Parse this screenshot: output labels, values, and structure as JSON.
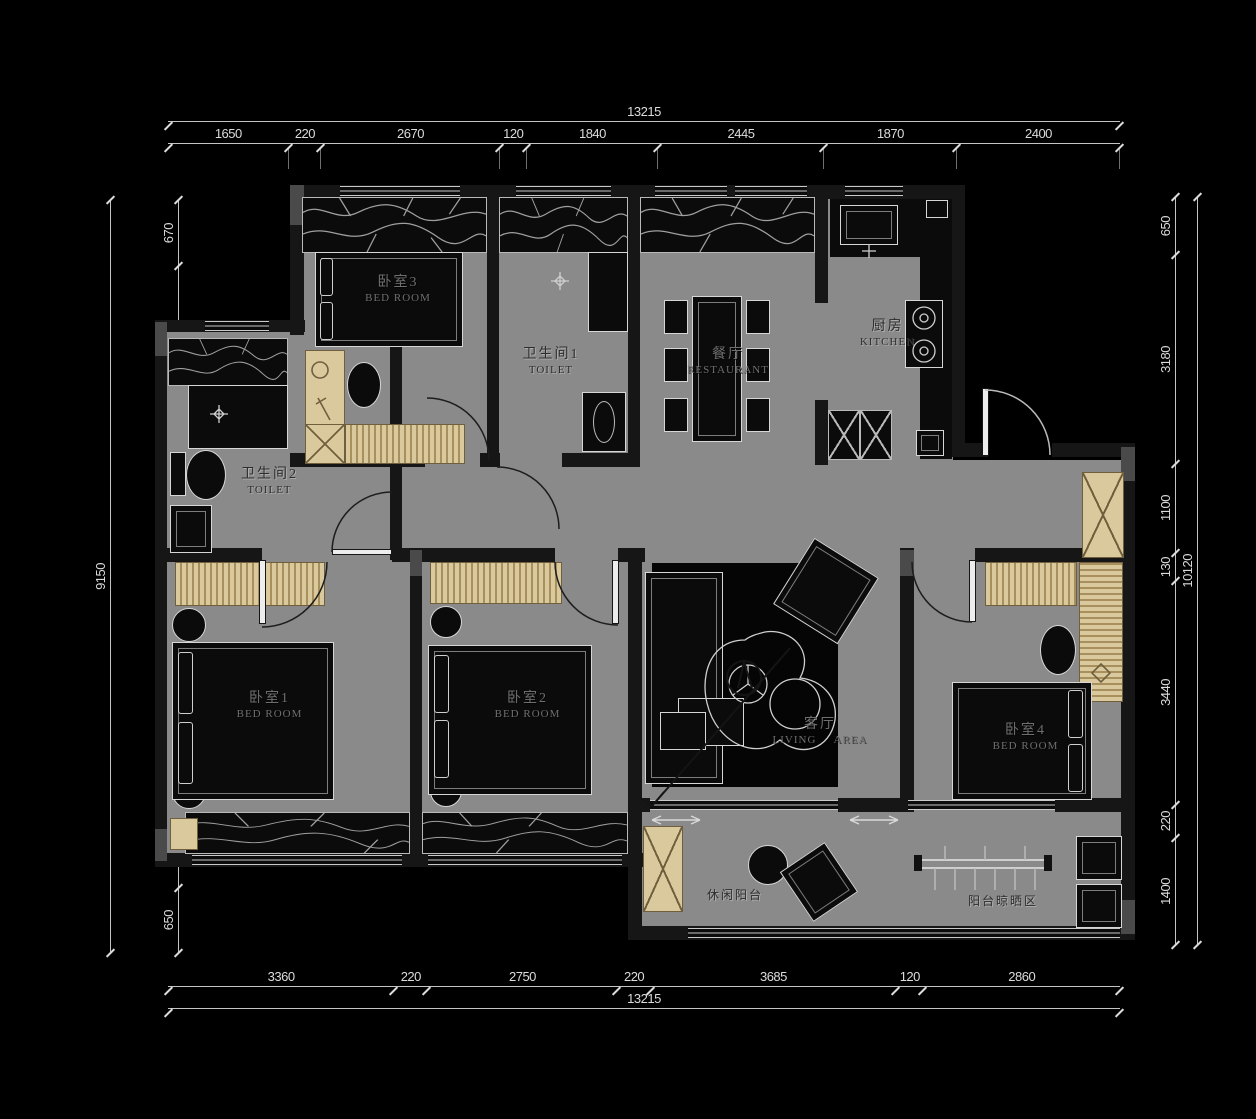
{
  "plan": {
    "type": "residential-floor-plan"
  },
  "colors": {
    "background": "#000000",
    "floor": "#8a8a8a",
    "wall": "#161616",
    "cabinet": "#dbc99e",
    "cabinet_border": "#6f5f3d",
    "outline": "#d6d6d6",
    "dimension": "#dcdcdc"
  },
  "dims": {
    "top": {
      "total": "13215",
      "segs": [
        "1650",
        "220",
        "2670",
        "120",
        "1840",
        "2445",
        "1870",
        "2400"
      ]
    },
    "bottom": {
      "total": "13215",
      "segs": [
        "3360",
        "220",
        "2750",
        "220",
        "3685",
        "120",
        "2860"
      ]
    },
    "left": {
      "total": "9150",
      "segs": [
        "670",
        "3040",
        "1290",
        "3500",
        "650"
      ]
    },
    "right": {
      "total": "10120",
      "segs": [
        "650",
        "3180",
        "1100",
        "130",
        "3440",
        "220",
        "1400"
      ]
    }
  },
  "rooms": {
    "bedroom3": {
      "cn": "卧室3",
      "en": "BED ROOM"
    },
    "toilet1": {
      "cn": "卫生间1",
      "en": "TOILET"
    },
    "dining": {
      "cn": "餐厅",
      "en": "RESTAURANT"
    },
    "kitchen": {
      "cn": "厨房",
      "en": "KITCHEN"
    },
    "toilet2": {
      "cn": "卫生间2",
      "en": "TOILET"
    },
    "bedroom1": {
      "cn": "卧室1",
      "en": "BED ROOM"
    },
    "bedroom2": {
      "cn": "卧室2",
      "en": "BED ROOM"
    },
    "living": {
      "cn": "客厅",
      "en": "LIVING AREA"
    },
    "bedroom4": {
      "cn": "卧室4",
      "en": "BED ROOM"
    },
    "balcony_leisure": {
      "cn": "休闲阳台"
    },
    "balcony_drying": {
      "cn": "阳台晾晒区"
    }
  }
}
